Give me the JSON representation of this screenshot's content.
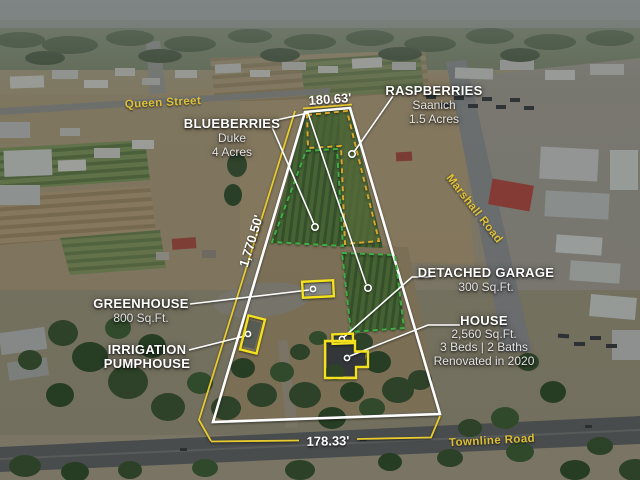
{
  "streets": {
    "queen": "Queen Street",
    "marshall": "Marshall Road",
    "townline": "Townline Road"
  },
  "dimensions": {
    "top": "180.63'",
    "left": "1,770.50'",
    "bottom": "178.33'"
  },
  "features": {
    "blueberries": {
      "title": "BLUEBERRIES",
      "variety": "Duke",
      "size": "4 Acres"
    },
    "raspberries": {
      "title": "RASPBERRIES",
      "variety": "Saanich",
      "size": "1.5 Acres"
    },
    "greenhouse": {
      "title": "GREENHOUSE",
      "size": "800 Sq.Ft."
    },
    "pumphouse": {
      "title_line1": "IRRIGATION",
      "title_line2": "PUMPHOUSE"
    },
    "garage": {
      "title": "DETACHED GARAGE",
      "size": "300 Sq.Ft."
    },
    "house": {
      "title": "HOUSE",
      "size": "2,560 Sq.Ft.",
      "beds_baths": "3 Beds | 2 Baths",
      "renovated": "Renovated in 2020"
    }
  },
  "colors": {
    "boundary": "#ffffff",
    "dimension_line": "#e8cb2e",
    "highlight_box": "#f2e11c",
    "blueberry_outline": "#3fae46",
    "raspberry_outline": "#d9a62e",
    "road_label": "#e9c832"
  }
}
